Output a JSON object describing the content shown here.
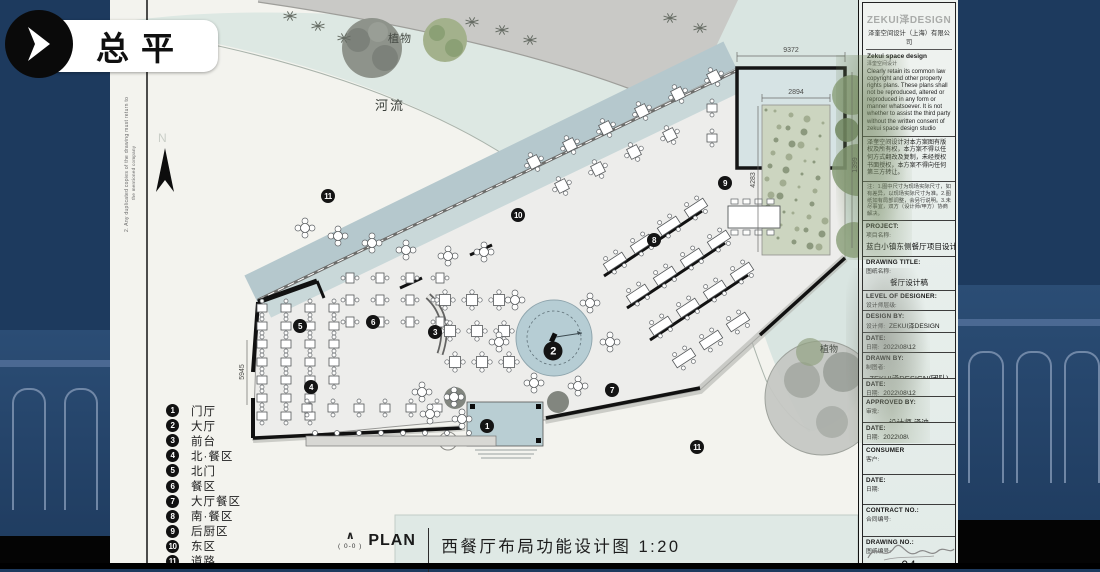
{
  "tab": {
    "label": "总平"
  },
  "plan": {
    "labels": {
      "river": "河流",
      "plants_top": "植物",
      "plants_right": "植物",
      "north": "N"
    },
    "dims": {
      "top": "9372",
      "plant_w": "2894",
      "plant_h": "4283",
      "right_h": "1399",
      "left_h": "5945"
    },
    "markers": [
      {
        "n": "11",
        "x": 328,
        "y": 196
      },
      {
        "n": "10",
        "x": 518,
        "y": 215
      },
      {
        "n": "9",
        "x": 725,
        "y": 183
      },
      {
        "n": "8",
        "x": 654,
        "y": 240
      },
      {
        "n": "5",
        "x": 300,
        "y": 326
      },
      {
        "n": "6",
        "x": 373,
        "y": 322
      },
      {
        "n": "3",
        "x": 435,
        "y": 332
      },
      {
        "n": "4",
        "x": 311,
        "y": 387
      },
      {
        "n": "7",
        "x": 612,
        "y": 390
      },
      {
        "n": "2",
        "x": 553,
        "y": 351,
        "big": true
      },
      {
        "n": "1",
        "x": 487,
        "y": 426
      },
      {
        "n": "11",
        "x": 697,
        "y": 447
      }
    ],
    "margin_note_1": "2. Any duplicated copies of the drawing must return to",
    "margin_note_2": "the mentioned company"
  },
  "legend": {
    "items": [
      {
        "n": "1",
        "label": "门厅"
      },
      {
        "n": "2",
        "label": "大厅"
      },
      {
        "n": "3",
        "label": "前台"
      },
      {
        "n": "4",
        "label": "北·餐区"
      },
      {
        "n": "5",
        "label": "北门"
      },
      {
        "n": "6",
        "label": "餐区"
      },
      {
        "n": "7",
        "label": "大厅餐区"
      },
      {
        "n": "8",
        "label": "南·餐区"
      },
      {
        "n": "9",
        "label": "后厨区"
      },
      {
        "n": "10",
        "label": "东区"
      },
      {
        "n": "11",
        "label": "道路"
      }
    ]
  },
  "caption": {
    "plan_word": "PLAN",
    "section_ref": "( 0-0 )",
    "title": "西餐厅布局功能设计图 1:20"
  },
  "titleblock": {
    "brand": "ZEKUI泽DESIGN",
    "company_cn": "泽奎空间设计（上海）有限公司",
    "company_en": "Zekui space design",
    "company_en2": "泽奎空间设计",
    "copyright_en": "Clearly retain its common law copyright and other property rights plans. These plans shall not be reproduced, altered or reproduced in any form or manner whatsoever. It is not whether to assist the third party without the written consent of zekui space design studio",
    "copyright_cn": "泽奎空间设计对本方案图有版权及所有权，本方案不得以任何方式翻改及复制，未经授权书面授权，本方案不得向任何第三方转让。",
    "notes": "注：1.图中尺寸为现场实际尺寸，如有差异，以现场实际尺寸为准。2.图纸如有局部调整，会另行说明。3.未尽事宜，双方（设计师/甲方）协商解决。",
    "rows": [
      {
        "en": "PROJECT:",
        "cn": "项目名称:",
        "value": "蓝白小镇东侧餐厅项目设计",
        "h": 36,
        "vclass": "v-md"
      },
      {
        "en": "DRAWING TITLE:",
        "cn": "图纸名称:",
        "value": "餐厅设计稿",
        "h": 34,
        "vclass": "v-md"
      },
      {
        "en": "LEVEL OF DESIGNER:",
        "cn": "设计师层级:",
        "value": "",
        "h": 20
      },
      {
        "en": "DESIGN BY:",
        "cn": "设计师:",
        "value": "ZEKUI泽DESIGN",
        "h": 22,
        "vclass": "v-in"
      },
      {
        "en": "DATE:",
        "cn": "日期:",
        "value": "2022\\08\\12",
        "h": 20,
        "vclass": "v-in"
      },
      {
        "en": "DRAWN BY:",
        "cn": "制图者:",
        "value": "ZEKUI泽DESIGN(团队)",
        "h": 26,
        "vclass": "v-md"
      },
      {
        "en": "DATE:",
        "cn": "日期:",
        "value": "2022\\08\\12",
        "h": 18,
        "vclass": "v-in"
      },
      {
        "en": "APPROVED BY:",
        "cn": "审批:",
        "value": "设计师.泽迪",
        "h": 26,
        "vclass": "v-md"
      },
      {
        "en": "DATE:",
        "cn": "日期:",
        "value": "2022\\08\\",
        "h": 22,
        "vclass": "v-in"
      },
      {
        "en": "CONSUMER",
        "cn": "客户:",
        "value": "",
        "h": 30
      },
      {
        "en": "DATE:",
        "cn": "日期:",
        "value": "",
        "h": 30
      },
      {
        "en": "CONTRACT NO.:",
        "cn": "合同编号:",
        "value": "",
        "h": 32
      },
      {
        "en": "DRAWING NO.:",
        "cn": "图纸编号:",
        "value": "04",
        "h": 46,
        "vclass": "v-big"
      }
    ]
  }
}
